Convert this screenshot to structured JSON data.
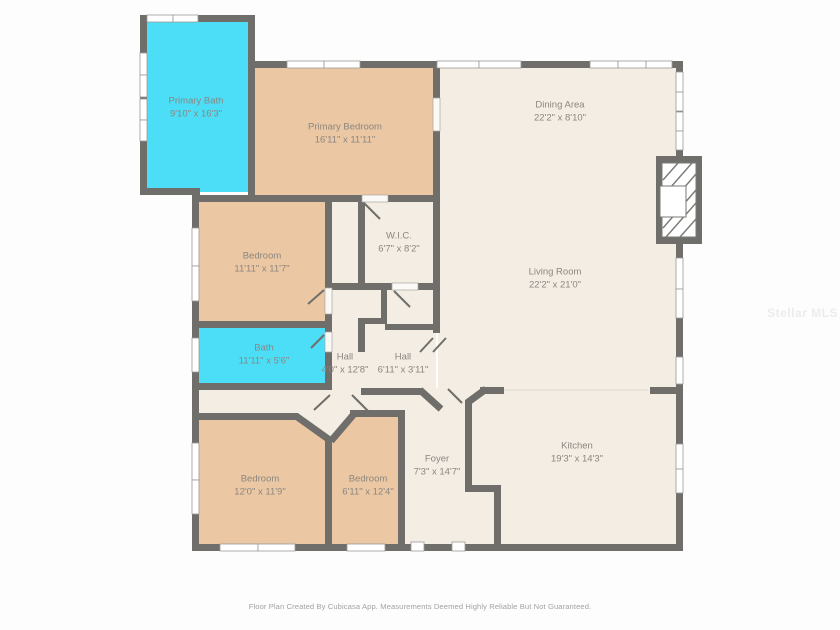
{
  "rooms": [
    {
      "name": "Primary Bath",
      "dims": "9'10\" x 16'3\""
    },
    {
      "name": "Primary Bedroom",
      "dims": "16'11\" x 11'11\""
    },
    {
      "name": "Dining Area",
      "dims": "22'2\" x 8'10\""
    },
    {
      "name": "Living Room",
      "dims": "22'2\" x 21'0\""
    },
    {
      "name": "W.I.C.",
      "dims": "6'7\" x 8'2\""
    },
    {
      "name": "Bedroom",
      "dims": "11'11\" x 11'7\""
    },
    {
      "name": "Bath",
      "dims": "11'11\" x 5'6\""
    },
    {
      "name": "Hall",
      "dims": "4'0\" x 12'8\""
    },
    {
      "name": "Hall",
      "dims": "6'11\" x 3'11\""
    },
    {
      "name": "Bedroom",
      "dims": "12'0\" x 11'9\""
    },
    {
      "name": "Bedroom",
      "dims": "6'11\" x 12'4\""
    },
    {
      "name": "Foyer",
      "dims": "7'3\" x 14'7\""
    },
    {
      "name": "Kitchen",
      "dims": "19'3\" x 14'3\""
    }
  ],
  "watermark": "Stellar MLS",
  "footer": "Floor Plan Created By Cubicasa App. Measurements Deemed Highly Reliable But Not Guaranteed.",
  "colors": {
    "wall": "#6f6e6a",
    "bath": "#4ddef7",
    "bedroom": "#ebc8a3",
    "common": "#f3ede3",
    "label": "#8b8680",
    "bg": "#fdfdfd"
  }
}
